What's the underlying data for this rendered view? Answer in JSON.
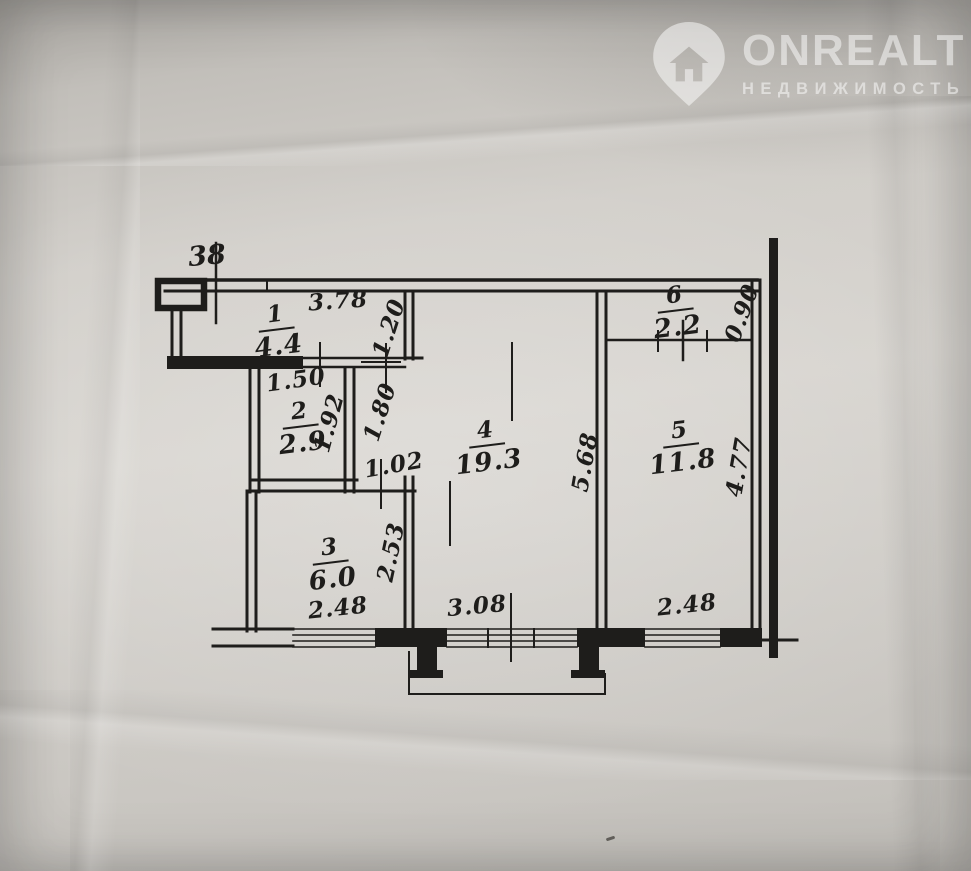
{
  "watermark": {
    "brand": "ONREALT",
    "subtitle": "НЕДВИЖИМОСТЬ",
    "icon": "house-pin-icon",
    "color": "rgba(255,255,255,0.5)"
  },
  "plan": {
    "apartment_number": "38",
    "ink_color": "#1e1d1b",
    "paper_color": "#d2cfca",
    "rooms": [
      {
        "number": "1",
        "area": "4.4"
      },
      {
        "number": "2",
        "area": "2.9"
      },
      {
        "number": "3",
        "area": "6.0"
      },
      {
        "number": "4",
        "area": "19.3"
      },
      {
        "number": "5",
        "area": "11.8"
      },
      {
        "number": "6",
        "area": "2.2"
      }
    ],
    "dims": {
      "hall_width": "3.78",
      "hall_passage": "1.20",
      "bath_width": "1.50",
      "bath_depth": "1.92",
      "corridor_depth": "1.80",
      "corridor_width": "1.02",
      "living_depth": "5.68",
      "kitchen_depth": "2.53",
      "closet_depth": "0.90",
      "bedroom_depth": "4.77",
      "window_left": "2.48",
      "window_center": "3.08",
      "window_right": "2.48"
    }
  }
}
